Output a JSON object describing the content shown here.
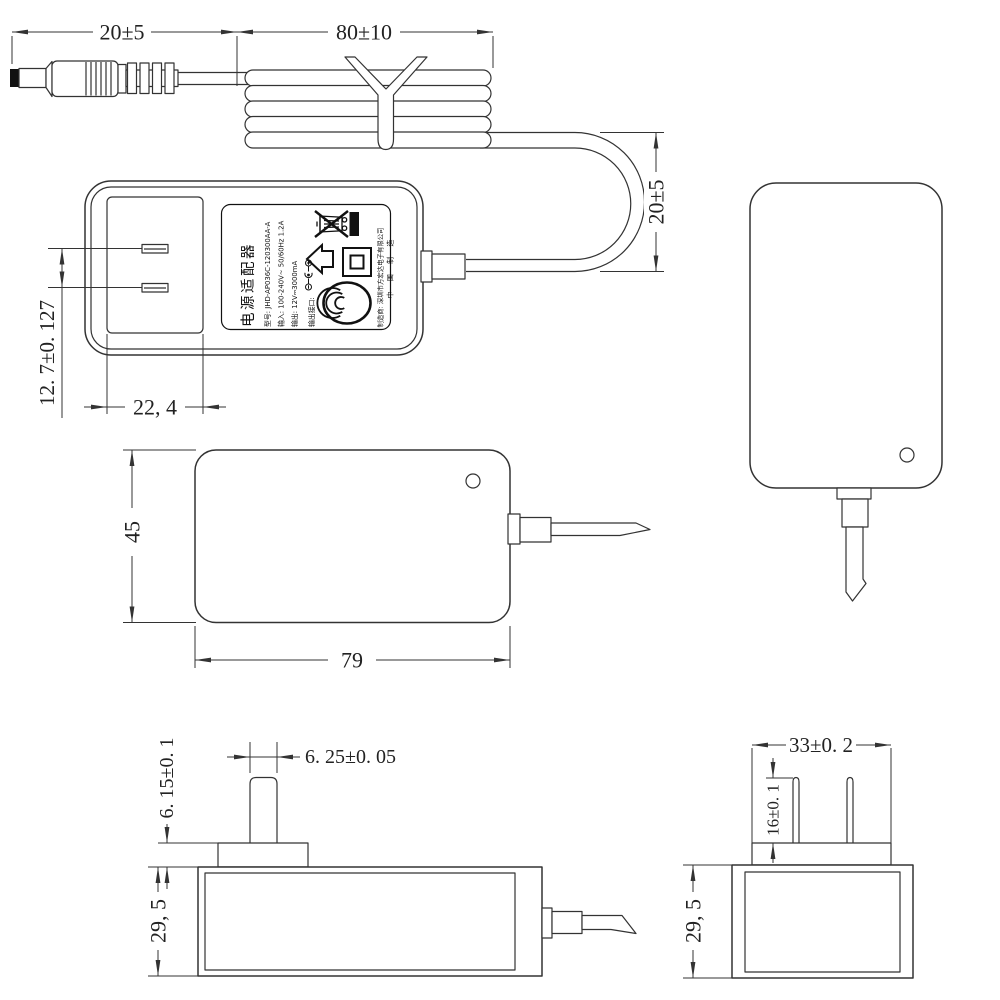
{
  "colors": {
    "line": "#333333",
    "ink": "#111111",
    "paper": "#ffffff"
  },
  "dimensions": {
    "plug_segment": "20±5",
    "coil_segment": "80±10",
    "loop_height": "20±5",
    "blade_pitch": "12. 7±0. 127",
    "recess_width": "22, 4",
    "body_height": "45",
    "body_width": "79",
    "blade_width": "6. 25±0. 05",
    "pedestal_height": "6. 15±0. 1",
    "body_depth_left": "29, 5",
    "pedestal_width": "33±0. 2",
    "blade_length": "16±0. 1",
    "body_depth_right": "29, 5"
  },
  "label": {
    "title": "电源适配器",
    "model_line": "型号: JHD-AP036C-120300AA-A",
    "input_line": "输入: 100-240V~ 50/60Hz 1.2A",
    "output_line": "输出: 12V⎓3000mA",
    "port_line": "输出接口:",
    "manufacturer_line": "制造商: 深圳市方宏达电子有限公司",
    "made_in": "中 国 制 造",
    "icons": [
      "weee-crossed-bin",
      "black-bar",
      "indoor-use-arrow-house",
      "class-ii-double-square",
      "ccc-mark",
      "polarity-center-positive"
    ]
  }
}
